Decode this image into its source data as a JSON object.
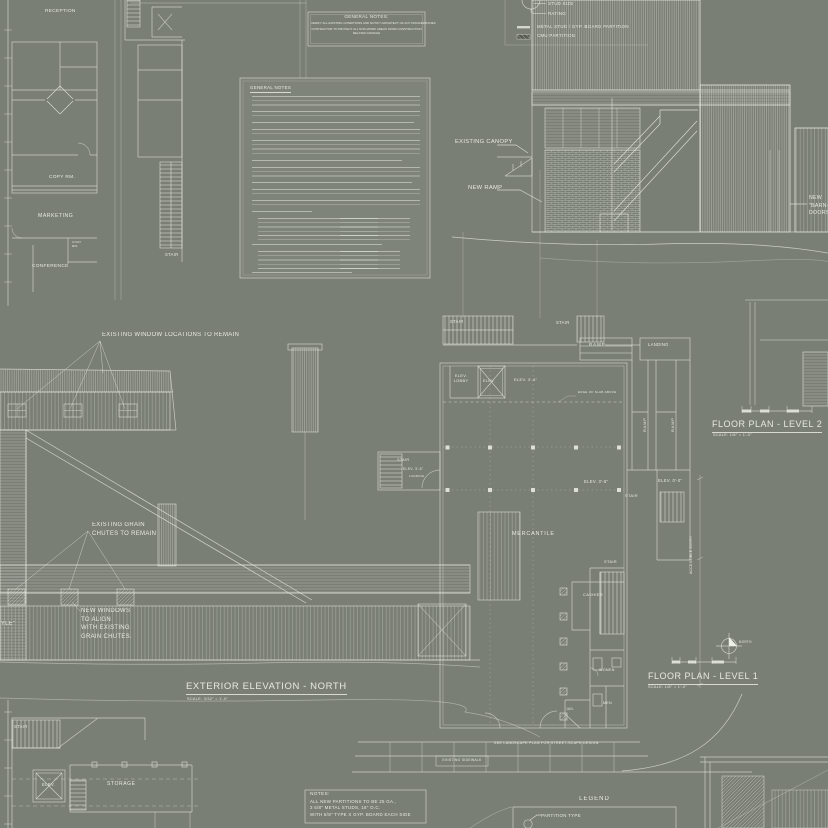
{
  "palette": {
    "background": "#7a7f75",
    "line": "#e9ece1",
    "text": "#ecefe4",
    "dark_fill": "#565a52"
  },
  "office_plan": {
    "reception": "RECEPTION",
    "copy_room": "COPY RM.",
    "marketing": "MARKETING",
    "conference": "CONFERENCE",
    "coat_room": "COAT\nRM.",
    "stair": "STAIR"
  },
  "general_notes_box": {
    "title": "GENERAL NOTES:",
    "line1": "VERIFY ALL EXISTING CONDITIONS AND NOTIFY ARCHITECT OF ANY DISCREPANCIES",
    "line2": "CONTRACTOR TO PROTECT ALL NON-WORK AREAS FROM CONSTRUCTION\nRELATED DAMAGE"
  },
  "notes_sheet": {
    "heading": "GENERAL NOTES"
  },
  "partition_legend": {
    "stud_size": "STUD SIZE",
    "rating": "RATING",
    "metal_stud": "METAL STUD / GYP. BOARD PARTITION",
    "cmu": "CMU PARTITION"
  },
  "section": {
    "existing_canopy": "EXISTING CANOPY",
    "new_ramp": "NEW RAMP",
    "barn_doors": "NEW\n\"BARN-STYLE\"\nDOORS"
  },
  "elevation": {
    "windows_note": "EXISTING WINDOW LOCATIONS TO REMAIN",
    "grain_note": "EXISTING GRAIN\nCHUTES TO REMAIN",
    "new_windows_note": "NEW WINDOWS\nTO ALIGN\nWITH EXISTING\nGRAIN CHUTES.",
    "barn_doors": "NEW\n\"BARN-STYLE\"\nDOORS",
    "title": "EXTERIOR ELEVATION - NORTH",
    "scale": "SCALE: 3/32\" = 1'-0\""
  },
  "level1": {
    "stair": "STAIR",
    "ramp": "RAMP",
    "landing": "LANDING",
    "ramp_vertical": "RAMP",
    "elev_lobby": "ELEV.\nLOBBY",
    "elev": "ELEV.",
    "spot_3_6": "ELEV. 3'-6\"",
    "spot_0_0": "ELEV. 0'-0\"",
    "edge_of_slab": "EDGE OF SLAB ABOVE",
    "mercantile": "MERCANTILE",
    "cashier": "CASHIER",
    "women": "WOMEN",
    "men": "MEN",
    "jan": "JAN.",
    "accessible_entry": "ACCESSIBLE ENTRY",
    "sidewalk": "EXISTING SIDEWALK",
    "landscape_note": "SEE LANDSCAPE PLAN FOR STREET-SCAPE DESIGN",
    "north": "NORTH",
    "title": "FLOOR PLAN - LEVEL 1",
    "scale": "SCALE: 1/8\" = 1'-0\""
  },
  "level2": {
    "title": "FLOOR PLAN - LEVEL 2",
    "scale": "SCALE: 1/8\" = 1'-0\""
  },
  "basement_plan": {
    "stair": "STAIR",
    "elev": "ELEV.",
    "storage": "STORAGE"
  },
  "notes_box": {
    "title": "NOTES:",
    "line1": "ALL NEW PARTITIONS TO BE 25 GA.,",
    "line2": "3 5/8\" METAL STUDS, 16\" O.C.",
    "line3": "WITH 5/8\" TYPE X GYP. BOARD EACH SIDE"
  },
  "legend_box": {
    "title": "LEGEND",
    "partition_type": "PARTITION TYPE"
  }
}
